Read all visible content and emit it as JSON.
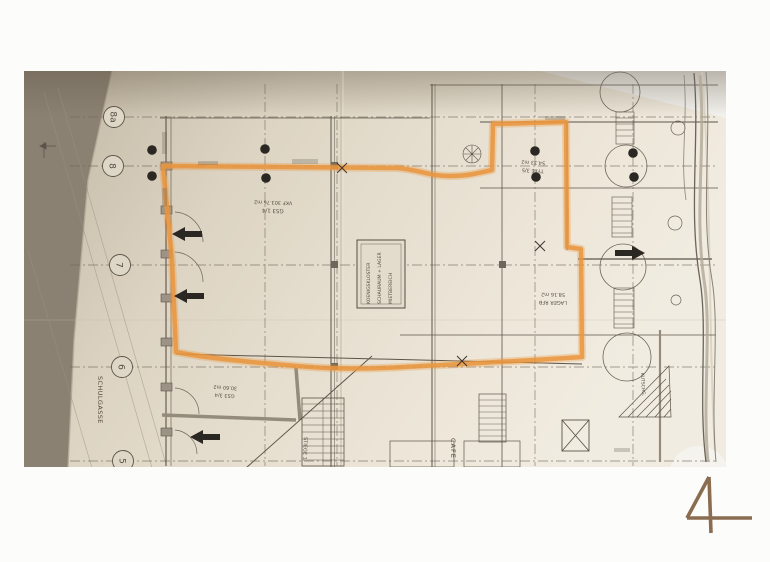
{
  "page": {
    "number": "4",
    "background_color": "#fcfcfb",
    "numeral_color": "#8a6c51"
  },
  "photo": {
    "highlight_color": "#e9953d",
    "paper_color": "#e6ddcd",
    "backdrop_color": "#8b8173",
    "street_label": "SCHULGASSE",
    "grid_bubbles": [
      "8a",
      "8",
      "7",
      "6",
      "5"
    ],
    "stamp": {
      "lines": [
        "KOENIGSKLOSTER",
        "SCHAURAUM + LAGER",
        "MIETBEREICH"
      ]
    },
    "room_labels": {
      "gs314_line1": "GS3 1/4",
      "gs314_line2": "VKF 303.76 m2",
      "type35_line1": "TYPE 3/5",
      "type35_line2": "54.33 m2",
      "lager_line1": "LAGER RFB",
      "lager_line2": "58.16 m2",
      "gs334_line1": "GS3 3/4",
      "gs334_line2": "30.60 m2",
      "cafe": "CAFE",
      "stiege": "STIEGE 1",
      "side_street": "KUTSCHG."
    }
  }
}
